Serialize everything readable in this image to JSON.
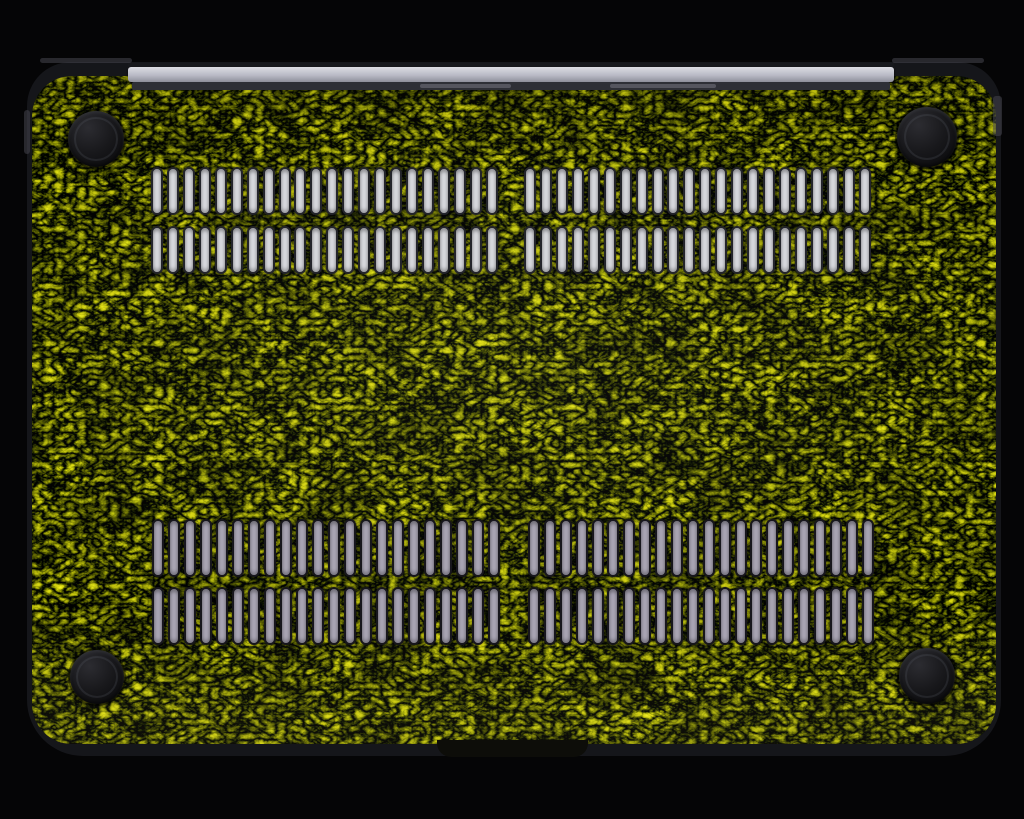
{
  "meta": {
    "description": "Product photograph: bottom exterior of a laptop shell covered in a preserved moss skin, two pairs of vent slot rows, four round rubber feet, silver hinge clutch bar at top, on a black background."
  },
  "scene": {
    "background_color": "#050506",
    "case": {
      "x": 27,
      "y": 62,
      "width": 974,
      "height": 694,
      "radius_top": 44,
      "radius_bottom": 56,
      "rim_color": "#15161a",
      "rim_highlight": "#45464e"
    },
    "moss": {
      "inset_top": 14,
      "inset_side": 5,
      "inset_bottom": 12,
      "radius": 40,
      "palette": {
        "base": "#9ba03e",
        "dark_olive": "#5f6126",
        "light_straw": "#ccc46c",
        "fleck_green": "#7cb33e",
        "twig_brown": "#4a3418"
      }
    },
    "hinge": {
      "x": 128,
      "y": 63,
      "width": 766,
      "top_strip_height": 4,
      "bar_height": 15,
      "groove_height": 8,
      "top_strip_color": "#17181c",
      "bar_color_top": "#dcdde3",
      "bar_color_mid": "#b9bac5",
      "bar_color_bottom": "#8e8f9b",
      "groove_color": "#2e2f36",
      "segment_color": "#55555e",
      "segments": [
        {
          "left_pct": 38,
          "width_pct": 12
        },
        {
          "left_pct": 63,
          "width_pct": 14
        }
      ]
    },
    "front_lip": {
      "x": 437,
      "y": 740,
      "width": 151,
      "height": 17,
      "color": "#0d0d09"
    },
    "feet": {
      "color_outer": "#0c0c0e",
      "color_mid": "#18181b",
      "color_highlight": "#2c2c31",
      "items": [
        {
          "position": "top-left",
          "cx": 96,
          "cy": 139,
          "r": 28
        },
        {
          "position": "top-right",
          "cx": 927,
          "cy": 137,
          "r": 30
        },
        {
          "position": "bottom-left",
          "cx": 97,
          "cy": 677,
          "r": 27
        },
        {
          "position": "bottom-right",
          "cx": 927,
          "cy": 676,
          "r": 28
        }
      ]
    },
    "vents": {
      "palettes": {
        "top": {
          "fill": "#d6d7dc",
          "outline": "#23242a"
        },
        "bottom": {
          "fill": "#a8a4b3",
          "outline": "#17161c"
        }
      },
      "groups": [
        {
          "id": "top-left",
          "x": 151,
          "y": 167,
          "width": 347,
          "rows": 2,
          "row_height": 48,
          "row_gap": 11,
          "slots": 22,
          "palette": "top"
        },
        {
          "id": "top-right",
          "x": 524,
          "y": 167,
          "width": 347,
          "rows": 2,
          "row_height": 48,
          "row_gap": 11,
          "slots": 22,
          "palette": "top"
        },
        {
          "id": "bottom-left",
          "x": 152,
          "y": 519,
          "width": 348,
          "rows": 2,
          "row_height": 58,
          "row_gap": 10,
          "slots": 22,
          "palette": "bottom"
        },
        {
          "id": "bottom-right",
          "x": 528,
          "y": 519,
          "width": 346,
          "rows": 2,
          "row_height": 58,
          "row_gap": 10,
          "slots": 22,
          "palette": "bottom"
        }
      ]
    },
    "rim_details": {
      "top_edge_left": {
        "x": 40,
        "y": 58,
        "width": 92,
        "height": 5
      },
      "top_edge_right": {
        "x": 892,
        "y": 58,
        "width": 92,
        "height": 5
      },
      "left_step": {
        "x": 24,
        "y": 110,
        "width": 6,
        "height": 44
      },
      "right_step": {
        "x": 993,
        "y": 96,
        "width": 9,
        "height": 40
      }
    }
  }
}
